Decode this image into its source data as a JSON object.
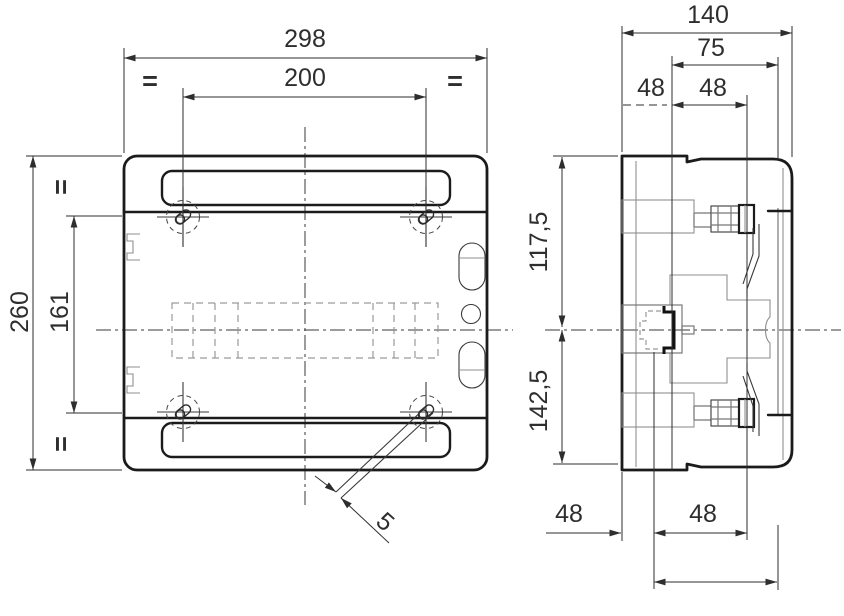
{
  "meta": {
    "background": "#ffffff",
    "main_line_color": "#1b1b1b",
    "secondary_line_color": "#8f8f8f",
    "dimension_color": "#2e2e2e"
  },
  "front_view": {
    "dim_width_total": "298",
    "dim_width_holes": "200",
    "dim_height_total": "260",
    "dim_height_holes": "161",
    "dim_strap_width": "5",
    "equal_mark_top_left": "=",
    "equal_mark_top_right": "=",
    "equal_mark_left_top": "=",
    "equal_mark_left_bottom": "="
  },
  "side_view": {
    "dim_depth_total": "140",
    "dim_depth_cover": "75",
    "dim_top_48_a": "48",
    "dim_top_48_b": "48",
    "dim_bottom_48_a": "48",
    "dim_bottom_48_b": "48",
    "dim_center_from_top": "117,5",
    "dim_center_from_bottom": "142,5"
  }
}
